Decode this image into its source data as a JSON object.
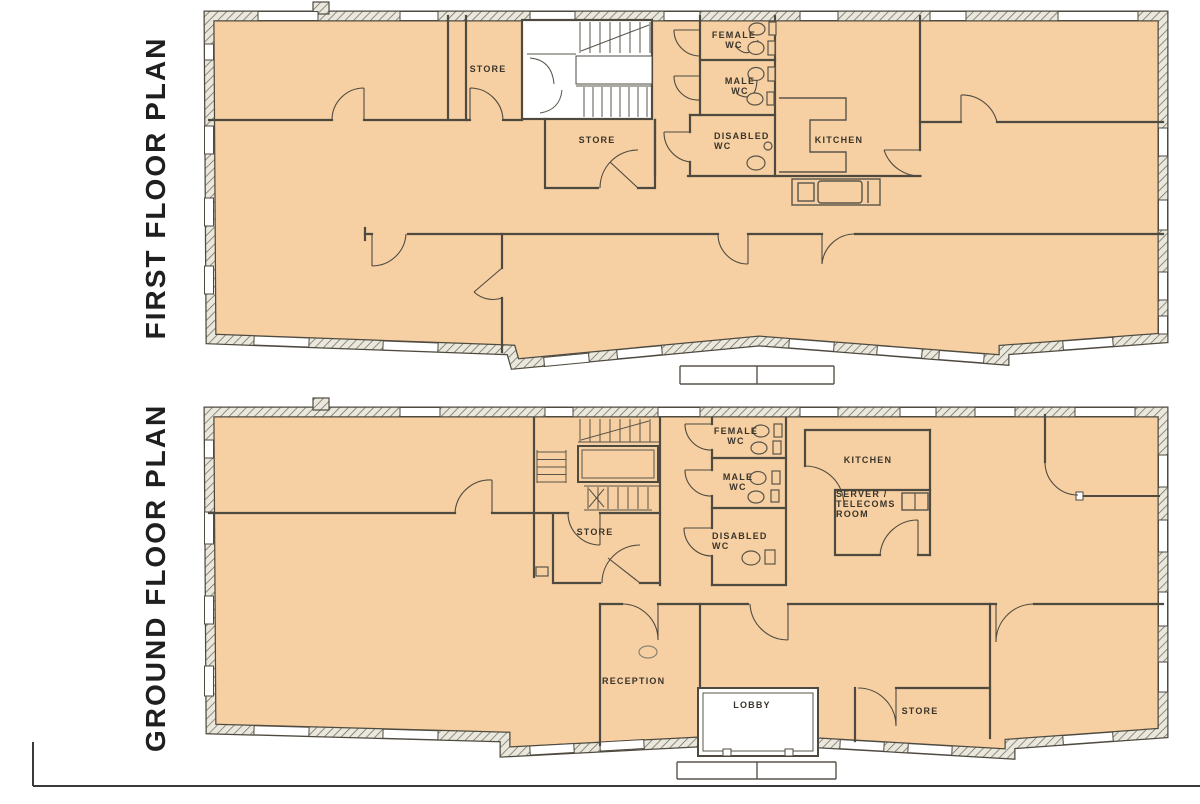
{
  "palette": {
    "floor_fill": "#f6d0a2",
    "wall_line": "#4f4a40",
    "hatch_background": "#eae8dd",
    "hatch_line": "#6f6a5e",
    "window_fill": "#ffffff",
    "label_color": "#3a342a",
    "title_color": "#1f1f1f"
  },
  "first_floor": {
    "title": "FIRST FLOOR PLAN",
    "rooms": [
      {
        "id": "store-left",
        "label": "STORE"
      },
      {
        "id": "female-wc",
        "label": "FEMALE WC"
      },
      {
        "id": "male-wc",
        "label": "MALE WC"
      },
      {
        "id": "store-mid",
        "label": "STORE"
      },
      {
        "id": "disabled-wc",
        "label": "DISABLED WC"
      },
      {
        "id": "kitchen",
        "label": "KITCHEN"
      }
    ]
  },
  "ground_floor": {
    "title": "GROUND FLOOR PLAN",
    "rooms": [
      {
        "id": "female-wc",
        "label": "FEMALE WC"
      },
      {
        "id": "male-wc",
        "label": "MALE WC"
      },
      {
        "id": "kitchen",
        "label": "KITCHEN"
      },
      {
        "id": "server-telecoms",
        "label": "SERVER / TELECOMS ROOM"
      },
      {
        "id": "store-mid",
        "label": "STORE"
      },
      {
        "id": "disabled-wc",
        "label": "DISABLED WC"
      },
      {
        "id": "reception",
        "label": "RECEPTION"
      },
      {
        "id": "lobby",
        "label": "LOBBY"
      },
      {
        "id": "store-right",
        "label": "STORE"
      }
    ]
  }
}
